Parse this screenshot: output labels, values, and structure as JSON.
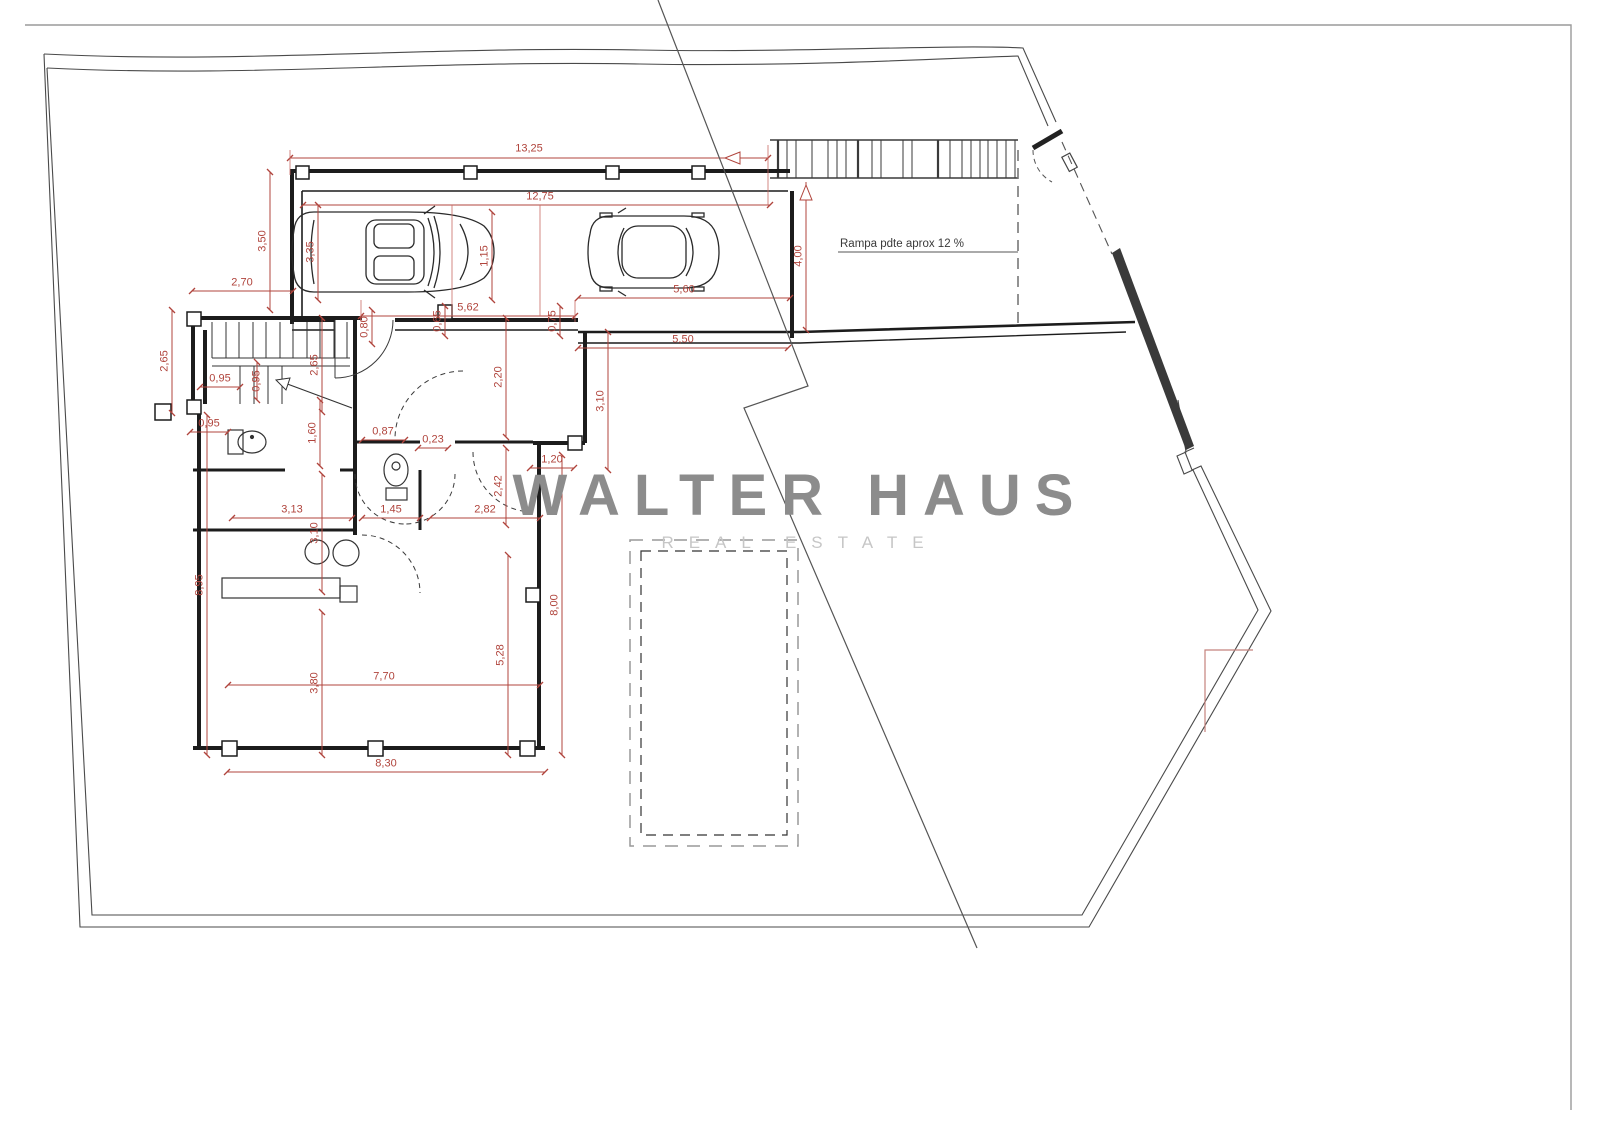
{
  "watermark": {
    "title": "WALTER HAUS",
    "subtitle": "REAL ESTATE"
  },
  "annotations": {
    "ramp_note": "Rampa pdte aprox 12 %"
  },
  "colors": {
    "dimension": "#b0443c",
    "walls": "#1c1c1c",
    "boundary": "#4a4a4a",
    "watermark_title": "#8c8c8c",
    "watermark_subtitle": "#c6c6c6",
    "background": "#ffffff"
  },
  "dimensions": [
    {
      "text": "13,25",
      "x": 529,
      "y": 149,
      "o": "h"
    },
    {
      "text": "12,75",
      "x": 540,
      "y": 197,
      "o": "h"
    },
    {
      "text": "3,50",
      "x": 263,
      "y": 241,
      "o": "v"
    },
    {
      "text": "3,35",
      "x": 311,
      "y": 252,
      "o": "v"
    },
    {
      "text": "1,15",
      "x": 485,
      "y": 256,
      "o": "v"
    },
    {
      "text": "4,00",
      "x": 799,
      "y": 256,
      "o": "v"
    },
    {
      "text": "2,70",
      "x": 242,
      "y": 283,
      "o": "h"
    },
    {
      "text": "5,60",
      "x": 684,
      "y": 290,
      "o": "h"
    },
    {
      "text": "5,62",
      "x": 468,
      "y": 308,
      "o": "h"
    },
    {
      "text": "0,65",
      "x": 438,
      "y": 321,
      "o": "v"
    },
    {
      "text": "0,75",
      "x": 553,
      "y": 321,
      "o": "v"
    },
    {
      "text": "0,80",
      "x": 365,
      "y": 327,
      "o": "v"
    },
    {
      "text": "5,50",
      "x": 683,
      "y": 340,
      "o": "h"
    },
    {
      "text": "2,65",
      "x": 165,
      "y": 361,
      "o": "v"
    },
    {
      "text": "2,65",
      "x": 315,
      "y": 365,
      "o": "v"
    },
    {
      "text": "2,20",
      "x": 499,
      "y": 377,
      "o": "v"
    },
    {
      "text": "0,95",
      "x": 220,
      "y": 379,
      "o": "h"
    },
    {
      "text": "0,95",
      "x": 257,
      "y": 381,
      "o": "v"
    },
    {
      "text": "3,10",
      "x": 601,
      "y": 401,
      "o": "v"
    },
    {
      "text": "0,95",
      "x": 209,
      "y": 424,
      "o": "h"
    },
    {
      "text": "0,87",
      "x": 383,
      "y": 432,
      "o": "h"
    },
    {
      "text": "1,60",
      "x": 313,
      "y": 433,
      "o": "v"
    },
    {
      "text": "0,23",
      "x": 433,
      "y": 440,
      "o": "h"
    },
    {
      "text": "1,20",
      "x": 552,
      "y": 460,
      "o": "h"
    },
    {
      "text": "2,42",
      "x": 499,
      "y": 486,
      "o": "v"
    },
    {
      "text": "3,13",
      "x": 292,
      "y": 510,
      "o": "h"
    },
    {
      "text": "1,45",
      "x": 391,
      "y": 510,
      "o": "h"
    },
    {
      "text": "2,82",
      "x": 485,
      "y": 510,
      "o": "h"
    },
    {
      "text": "3,10",
      "x": 315,
      "y": 533,
      "o": "v"
    },
    {
      "text": "8,95",
      "x": 200,
      "y": 585,
      "o": "v"
    },
    {
      "text": "8,00",
      "x": 555,
      "y": 605,
      "o": "v"
    },
    {
      "text": "5,28",
      "x": 501,
      "y": 655,
      "o": "v"
    },
    {
      "text": "3,80",
      "x": 315,
      "y": 683,
      "o": "v"
    },
    {
      "text": "7,70",
      "x": 384,
      "y": 677,
      "o": "h"
    },
    {
      "text": "8,30",
      "x": 386,
      "y": 764,
      "o": "h"
    }
  ]
}
